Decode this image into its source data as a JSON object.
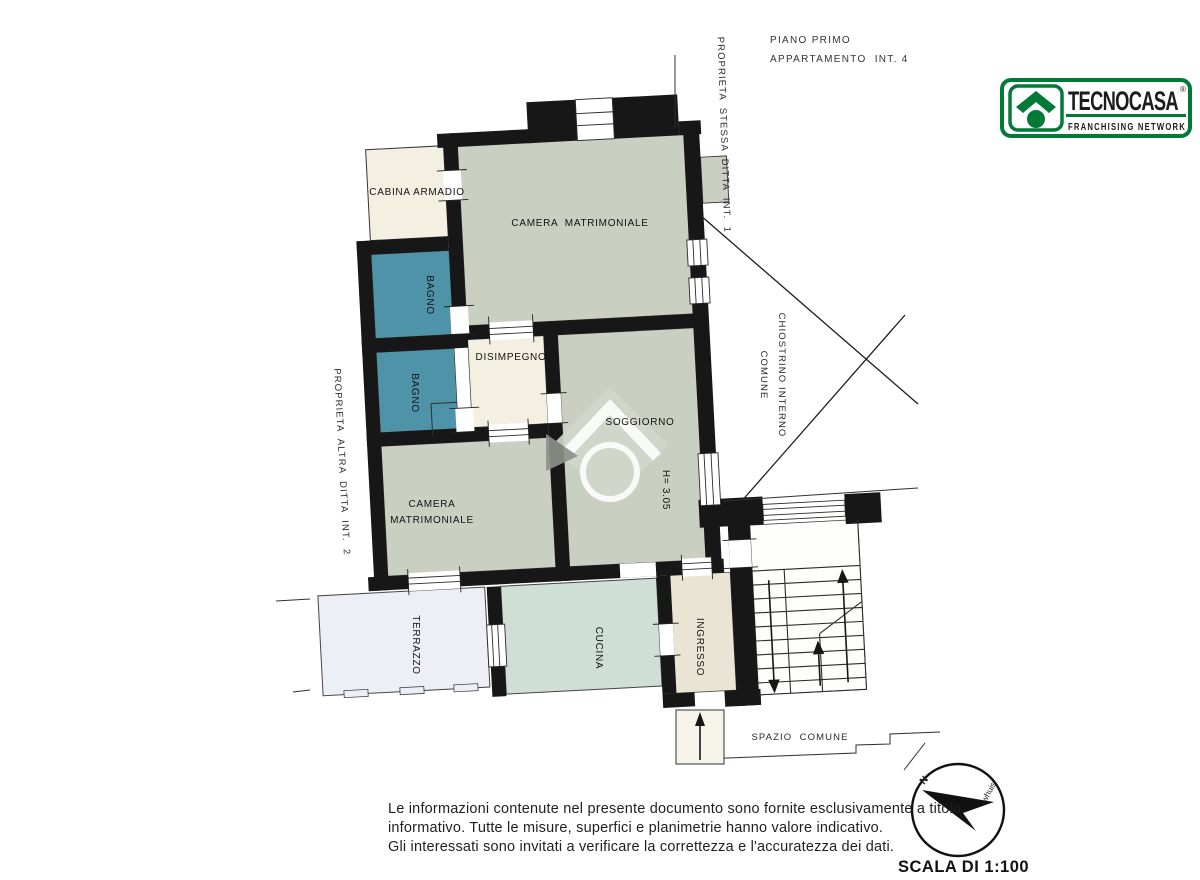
{
  "header": {
    "floor": "PIANO PRIMO",
    "apartment": "APPARTAMENTO  INT. 4"
  },
  "logo": {
    "brand": "TECNOCASA",
    "registered": "®",
    "tagline": "FRANCHISING NETWORK"
  },
  "rooms": {
    "cabina_armadio": "CABINA ARMADIO",
    "camera_matrimoniale_1": "CAMERA  MATRIMONIALE",
    "bagno_1": "BAGNO",
    "bagno_2": "BAGNO",
    "disimpegno": "DISIMPEGNO",
    "soggiorno": "SOGGIORNO",
    "camera_2_line1": "CAMERA",
    "camera_2_line2": "MATRIMONIALE",
    "terrazzo": "TERRAZZO",
    "cucina": "CUCINA",
    "ingresso": "INGRESSO"
  },
  "annotations": {
    "proprieta_stessa": "PROPRIETA  STESSA  DITTA  INT.  1",
    "proprieta_altra": "PROPRIETA  ALTRA  DITTA  INT.  2",
    "chiostrino_line1": "CHIOSTRINO INTERNO",
    "chiostrino_line2": "COMUNE",
    "altezza": "H= 3.05",
    "spazio_comune": "SPAZIO  COMUNE",
    "north": "N",
    "compass_script": "whuis"
  },
  "footer": {
    "disclaimer_line1": "Le informazioni contenute nel presente documento sono fornite esclusivamente a titolo",
    "disclaimer_line2": "informativo. Tutte le misure, superfici e planimetrie hanno valore indicativo.",
    "disclaimer_line3": "Gli interessati sono invitati a verificare la correttezza e l'accuratezza dei dati.",
    "scale": "SCALA DI 1:100"
  },
  "colors": {
    "wall": "#171717",
    "room_sage": "#c9cfc1",
    "room_teal": "#4f93a9",
    "room_cream": "#f3efe1",
    "room_kitchen": "#cfdfd5",
    "room_terrace": "#edeff6",
    "room_entry": "#e9e4d3",
    "landing_white": "#fdfdfc",
    "logo_green": "#007a36",
    "watermark_gray": "#d2d6cc",
    "watermark_dark": "#8e918b"
  }
}
